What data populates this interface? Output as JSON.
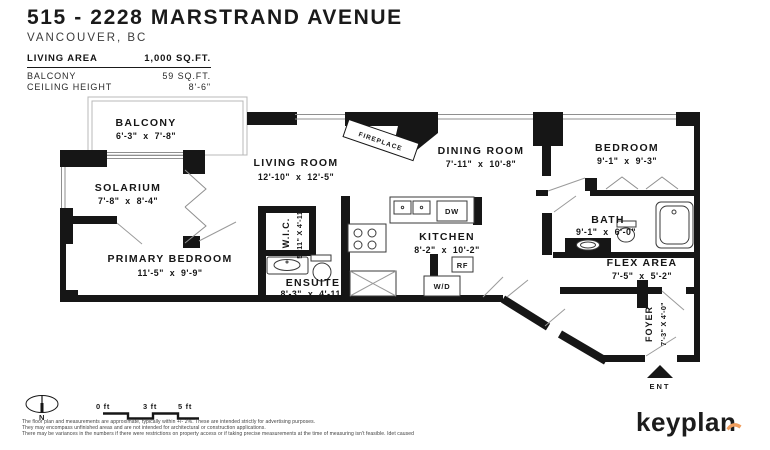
{
  "header": {
    "title": "515 - 2228 MARSTRAND AVENUE",
    "subtitle": "VANCOUVER, BC"
  },
  "stats": {
    "rows": [
      {
        "label": "LIVING AREA",
        "value": "1,000 SQ.FT."
      },
      {
        "label": "BALCONY",
        "value": "59 SQ.FT."
      },
      {
        "label": "CEILING HEIGHT",
        "value": "8'-6\""
      }
    ]
  },
  "rooms": {
    "balcony": {
      "name": "BALCONY",
      "dims": "6'-3\"  x  7'-8\""
    },
    "solarium": {
      "name": "SOLARIUM",
      "dims": "7'-8\"  x  8'-4\""
    },
    "living_room": {
      "name": "LIVING ROOM",
      "dims": "12'-10\"  x  12'-5\""
    },
    "dining_room": {
      "name": "DINING ROOM",
      "dims": "7'-11\"  x  10'-8\""
    },
    "bedroom": {
      "name": "BEDROOM",
      "dims": "9'-1\"  x  9'-3\""
    },
    "bath": {
      "name": "BATH",
      "dims": "9'-1\"  x  6'-0\""
    },
    "kitchen": {
      "name": "KITCHEN",
      "dims": "8'-2\"  x  10'-2\""
    },
    "primary_bedroom": {
      "name": "PRIMARY BEDROOM",
      "dims": "11'-5\"  x  9'-9\""
    },
    "wic": {
      "name": "W.I.C.",
      "dims": "5'-11\" X 4'-11\""
    },
    "ensuite": {
      "name": "ENSUITE",
      "dims": "8'-3\"  x  4'-11\""
    },
    "flex_area": {
      "name": "FLEX AREA",
      "dims": "7'-5\"  x  5'-2\""
    },
    "foyer": {
      "name": "FOYER",
      "dims": "7'-3\" X 4'-0\""
    }
  },
  "fixtures": {
    "fireplace": "FIREPLACE",
    "dishwasher": "DW",
    "refrigerator": "RF",
    "washer_dryer": "W/D"
  },
  "plan_annotations": {
    "entry": "ENT",
    "north": "N"
  },
  "scale_bar": {
    "ticks": [
      "0 ft",
      "3 ft",
      "5 ft"
    ]
  },
  "footer": {
    "disclaimer_lines": [
      "The floor plan and measurements are approximate, typically within +/- 2%. These are intended strictly for advertising purposes.",
      "They may encompass unfinished areas and are not intended for architectural or construction applications.",
      "There may be variances in the numbers if there were restrictions on property access or if taking precise measurements at the time of measuring isn't feasible. Idet caused"
    ]
  },
  "brand": {
    "logo_text": "keyplan"
  },
  "colors": {
    "wall": "#161616",
    "thin_line": "#8f8f8f",
    "accent_orange": "#ef9d5d"
  }
}
